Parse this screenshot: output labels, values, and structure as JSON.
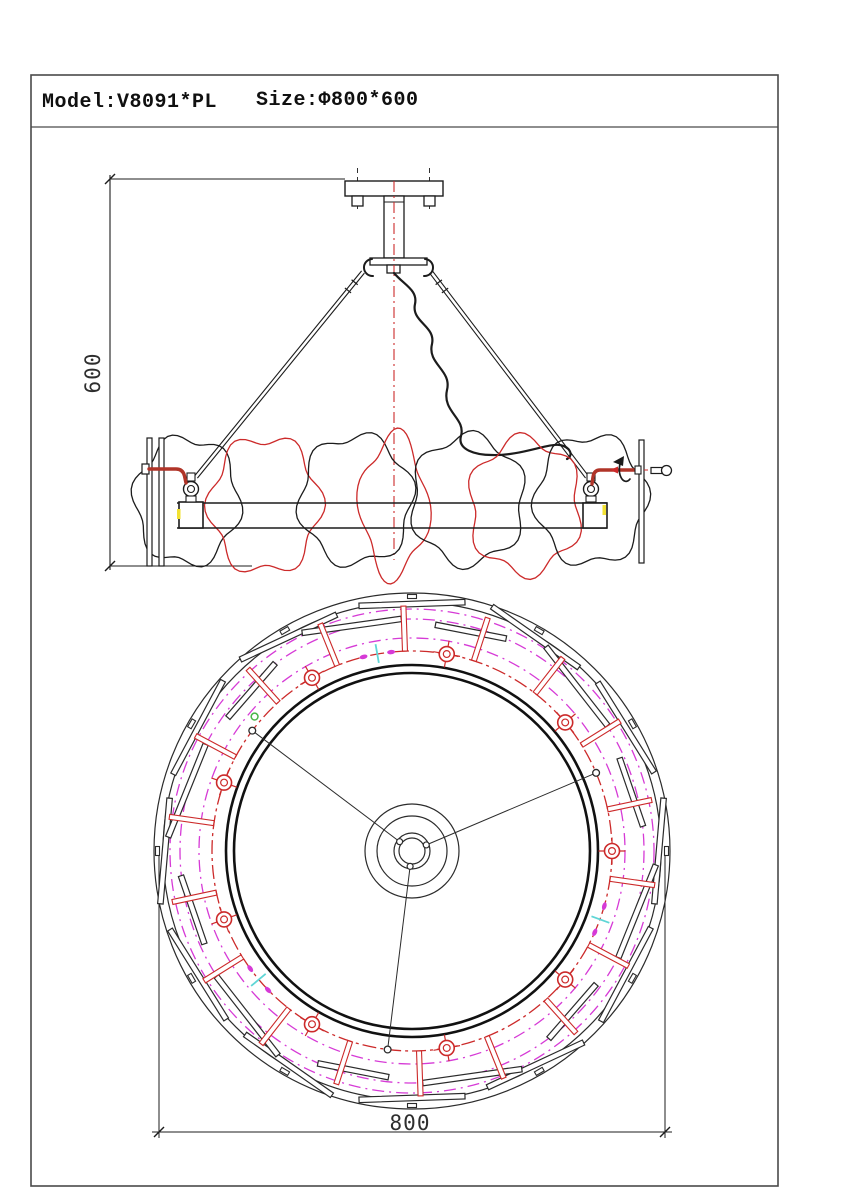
{
  "title_block": {
    "model": "Model:V8091*PL",
    "size": "Size:Φ800*600"
  },
  "dimensions": {
    "height": "600",
    "diameter": "800"
  },
  "colors": {
    "line": "#1c1c1c",
    "thin": "#2b2b2b",
    "border": "#4a4a4a",
    "red": "#cc2a2a",
    "dark_red": "#b03428",
    "magenta": "#d63ad6",
    "cyan": "#5fd6d6",
    "green": "#49b649",
    "yellow": "#f2e132",
    "dim_text": "#2e2e2e"
  },
  "drawing": {
    "border": {
      "x": 31,
      "y": 75,
      "w": 747,
      "h": 1111,
      "title_sep_y": 127
    },
    "elevation": {
      "axis_x": 394,
      "dim": {
        "x": 110,
        "y1": 179,
        "y2": 566,
        "ext_top_x2": 345,
        "ext_bot_x2": 252,
        "label_x": 100,
        "label_y": 373
      },
      "canopy": {
        "x": 345,
        "y": 181,
        "w": 98,
        "h": 15
      },
      "screws": [
        [
          352,
          196,
          11,
          10
        ],
        [
          424,
          196,
          11,
          10
        ]
      ],
      "screw_centerlines": [
        357.5,
        429.5
      ],
      "stem": {
        "x": 384,
        "y": 196,
        "w": 20,
        "h": 62
      },
      "flange": {
        "x": 370,
        "y": 258,
        "w": 57,
        "h": 7
      },
      "nut": {
        "x": 387,
        "y": 265,
        "w": 13,
        "h": 8
      },
      "hook_centers": [
        [
          366,
          268
        ],
        [
          431,
          268
        ]
      ],
      "centerline": {
        "x": 394,
        "y1": 181,
        "y2": 560
      },
      "rods": [
        {
          "x1": 363,
          "y1": 272,
          "x2": 196,
          "y2": 477
        },
        {
          "x1": 431,
          "y1": 272,
          "x2": 587,
          "y2": 477
        }
      ],
      "cable": "M 394 273 C 404 285 418 290 415 304 C 411 322 436 326 432 344 C 427 364 452 370 447 390 C 442 412 466 418 461 436 C 457 450 476 455 492 455 C 520 456 548 443 560 445 C 570 447 574 455 567 459",
      "blobs": [
        {
          "cx": 187,
          "cy": 501,
          "rx": 52,
          "ry": 63,
          "color": "black",
          "phase": 0.4,
          "lobes": 6,
          "amp": 0.09
        },
        {
          "cx": 265,
          "cy": 505,
          "rx": 55,
          "ry": 67,
          "color": "red",
          "phase": 1.7,
          "lobes": 6,
          "amp": 0.1
        },
        {
          "cx": 356,
          "cy": 500,
          "rx": 56,
          "ry": 64,
          "color": "black",
          "phase": 2.9,
          "lobes": 6,
          "amp": 0.09
        },
        {
          "cx": 394,
          "cy": 506,
          "rx": 33,
          "ry": 69,
          "color": "red",
          "phase": 0.9,
          "lobes": 4,
          "amp": 0.14
        },
        {
          "cx": 468,
          "cy": 500,
          "rx": 56,
          "ry": 64,
          "color": "black",
          "phase": 4.1,
          "lobes": 6,
          "amp": 0.09
        },
        {
          "cx": 525,
          "cy": 506,
          "rx": 55,
          "ry": 67,
          "color": "red",
          "phase": 5.3,
          "lobes": 6,
          "amp": 0.1
        },
        {
          "cx": 591,
          "cy": 500,
          "rx": 55,
          "ry": 64,
          "color": "black",
          "phase": 2.2,
          "lobes": 6,
          "amp": 0.09
        }
      ],
      "band": {
        "x1": 177,
        "x2": 607,
        "y1": 503,
        "y2": 528
      },
      "side_bars": [
        [
          147,
          438,
          5,
          128
        ],
        [
          159,
          438,
          5,
          128
        ],
        [
          639,
          440,
          5,
          123
        ]
      ],
      "boxes": [
        [
          179,
          502,
          24,
          26
        ],
        [
          583,
          503,
          24,
          25
        ]
      ],
      "yellow_ticks": [
        [
          177,
          509,
          3.5,
          10
        ],
        [
          602.5,
          505,
          3.5,
          10
        ]
      ],
      "joints": [
        [
          191,
          489
        ],
        [
          591,
          489
        ]
      ],
      "left_elbow": {
        "cap": [
          142,
          464,
          7,
          10
        ],
        "path": "M 149 469 L 176 469 Q 183 469 184.5 476 L 186 483"
      },
      "right_elbow": {
        "path": "M 637 470 L 600 470 Q 594 470 593 477 L 592 484",
        "dash_x2": 653,
        "arrow_tip": [
          610,
          470
        ],
        "block": [
          635,
          466,
          6,
          8
        ]
      },
      "rotation_arrow": {
        "path": "M 622 460 A 6.5 11.5 0 1 0 630 479",
        "head": "613,462 624,456 623,466"
      },
      "loose_screw": {
        "shaft": [
          651,
          467.5,
          11,
          6
        ],
        "head_cx": 666.5,
        "head_cy": 470.5,
        "head_r": 5
      }
    },
    "plan": {
      "cx": 412,
      "cy": 851,
      "outer_radii": [
        258,
        249
      ],
      "magenta_radii": [
        242,
        232,
        213
      ],
      "thick_radii": [
        186,
        178
      ],
      "lamp_circle_r": 200,
      "outer_bars": {
        "count": 12,
        "start": 90,
        "step": 30,
        "r": 247,
        "len": 106,
        "w": 5.5,
        "tilt": 5,
        "tick_r": 254.5,
        "tick_w": 9,
        "tick_h": 4
      },
      "inner_bars": {
        "count": 12,
        "start": 105,
        "step": 30,
        "r_a": 233,
        "r_b": 227,
        "len_a": 100,
        "len_b": 72,
        "w": 5.5,
        "tilt_a": 7,
        "tilt_b": -4
      },
      "radial_bars": {
        "count": 18,
        "start": 12,
        "step": 20,
        "r1": 200,
        "r2": 245,
        "w": 5
      },
      "lamps": {
        "count": 9,
        "start": 0,
        "step": 40,
        "r_outer": 7.5,
        "r_inner": 3.4,
        "cross": 13.5
      },
      "spokes": {
        "angles": [
          23,
          143,
          263
        ],
        "hub_r": 16,
        "point_r": 3.4
      },
      "green_marker": {
        "angle": 139.5,
        "r": 207,
        "size": 3.4
      },
      "wire_markers": {
        "angles": [
          100,
          220,
          340
        ],
        "cyan_r1": 191,
        "cyan_r2": 210,
        "dot_offset": 4,
        "dot_rx": 4,
        "dot_ry": 2.2
      },
      "hub_radii": [
        47,
        35,
        18,
        13
      ],
      "hub_pin_r": 15.5,
      "hub_pin_size": 3,
      "ext_x": [
        159,
        665
      ],
      "ext_y_top": 856,
      "dim_y": 1132,
      "dim_overshoot": 7,
      "label_x": 410,
      "label_y": 1130
    }
  }
}
